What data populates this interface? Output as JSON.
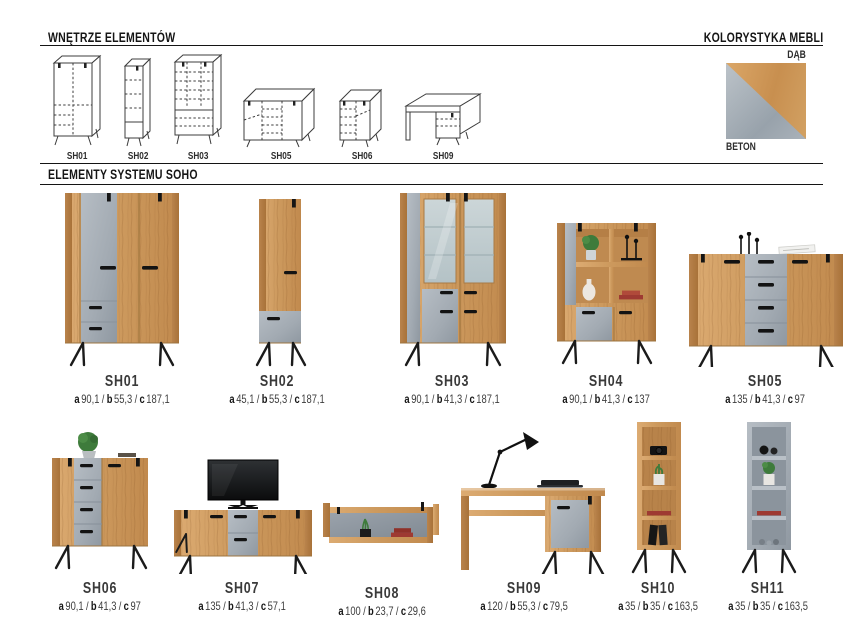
{
  "header": {
    "left_title": "WNĘTRZE ELEMENTÓW",
    "right_title": "KOLORYSTYKA MEBLI"
  },
  "swatch": {
    "top_label": "DĄB",
    "bottom_label": "BETON",
    "oak_color": "#cd9a5e",
    "concrete_color": "#a2abb3",
    "accent_black": "#141414"
  },
  "section": {
    "title": "ELEMENTY SYSTEMU SOHO"
  },
  "drawings": [
    {
      "code": "SH01"
    },
    {
      "code": "SH02"
    },
    {
      "code": "SH03"
    },
    {
      "code": "SH05"
    },
    {
      "code": "SH06"
    },
    {
      "code": "SH09"
    }
  ],
  "labels": {
    "a": "a",
    "b": "b",
    "c": "c",
    "sep": "/"
  },
  "products": [
    {
      "code": "SH01",
      "dims": {
        "a": "90,1",
        "b": "55,3",
        "c": "187,1"
      }
    },
    {
      "code": "SH02",
      "dims": {
        "a": "45,1",
        "b": "55,3",
        "c": "187,1"
      }
    },
    {
      "code": "SH03",
      "dims": {
        "a": "90,1",
        "b": "41,3",
        "c": "187,1"
      }
    },
    {
      "code": "SH04",
      "dims": {
        "a": "90,1",
        "b": "41,3",
        "c": "137"
      }
    },
    {
      "code": "SH05",
      "dims": {
        "a": "135",
        "b": "41,3",
        "c": "97"
      }
    },
    {
      "code": "SH06",
      "dims": {
        "a": "90,1",
        "b": "41,3",
        "c": "97"
      }
    },
    {
      "code": "SH07",
      "dims": {
        "a": "135",
        "b": "41,3",
        "c": "57,1"
      }
    },
    {
      "code": "SH08",
      "dims": {
        "a": "100",
        "b": "23,7",
        "c": "29,6"
      }
    },
    {
      "code": "SH09",
      "dims": {
        "a": "120",
        "b": "55,3",
        "c": "79,5"
      }
    },
    {
      "code": "SH10",
      "dims": {
        "a": "35",
        "b": "35",
        "c": "163,5"
      }
    },
    {
      "code": "SH11",
      "dims": {
        "a": "35",
        "b": "35",
        "c": "163,5"
      }
    }
  ]
}
